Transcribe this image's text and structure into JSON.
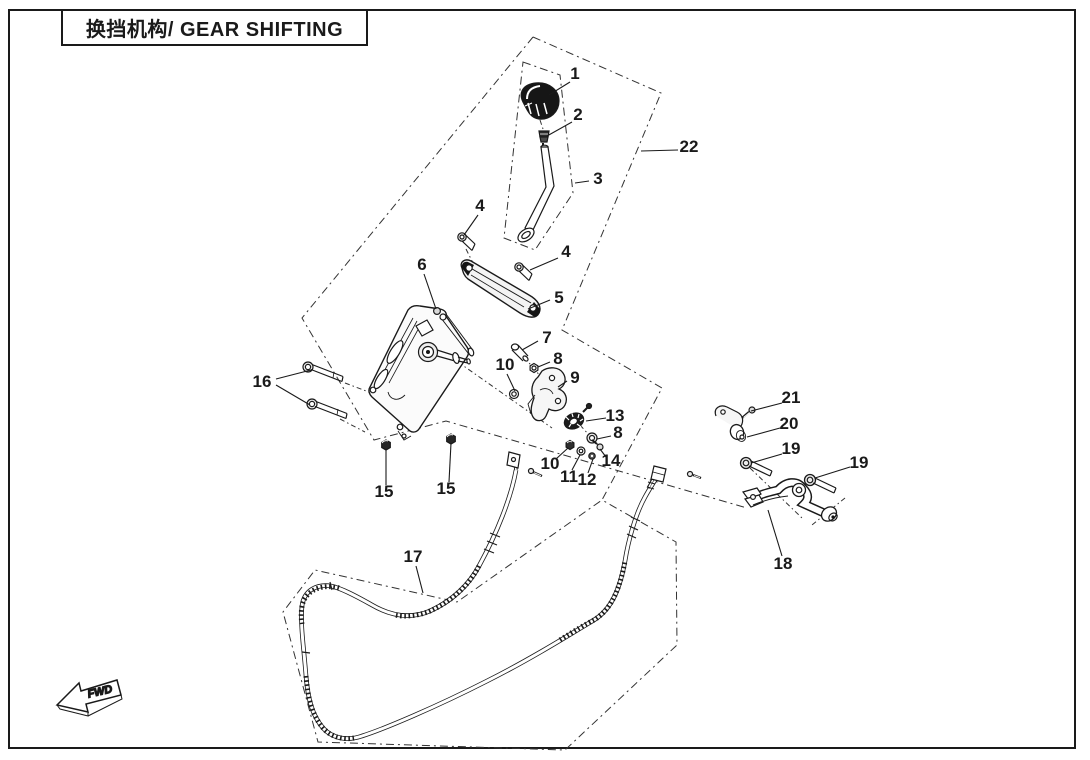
{
  "title": {
    "text": "换挡机构/ GEAR SHIFTING"
  },
  "direction_marker": {
    "label": "FWD"
  },
  "colors": {
    "ink": "#1a1a1a",
    "background": "#ffffff",
    "dash": "#333333"
  },
  "callouts": [
    {
      "num": "1",
      "x": 575,
      "y": 79,
      "leaders": [
        [
          570,
          82,
          549,
          95
        ]
      ]
    },
    {
      "num": "2",
      "x": 578,
      "y": 120,
      "leaders": [
        [
          572,
          122,
          547,
          136
        ]
      ]
    },
    {
      "num": "3",
      "x": 598,
      "y": 184,
      "leaders": [
        [
          589,
          181,
          575,
          183
        ]
      ]
    },
    {
      "num": "4",
      "x": 480,
      "y": 211,
      "leaders": [
        [
          478,
          215,
          464,
          235
        ]
      ]
    },
    {
      "num": "4",
      "x": 566,
      "y": 257,
      "leaders": [
        [
          558,
          258,
          530,
          270
        ]
      ]
    },
    {
      "num": "5",
      "x": 559,
      "y": 303,
      "leaders": [
        [
          550,
          300,
          528,
          309
        ]
      ]
    },
    {
      "num": "6",
      "x": 422,
      "y": 270,
      "leaders": [
        [
          424,
          274,
          436,
          309
        ]
      ]
    },
    {
      "num": "7",
      "x": 547,
      "y": 343,
      "leaders": [
        [
          538,
          341,
          522,
          350
        ]
      ]
    },
    {
      "num": "8",
      "x": 558,
      "y": 364,
      "leaders": [
        [
          550,
          362,
          538,
          367
        ]
      ]
    },
    {
      "num": "9",
      "x": 575,
      "y": 383,
      "leaders": [
        [
          567,
          381,
          558,
          387
        ]
      ]
    },
    {
      "num": "10",
      "x": 505,
      "y": 370,
      "leaders": [
        [
          507,
          374,
          515,
          391
        ]
      ]
    },
    {
      "num": "13",
      "x": 615,
      "y": 421,
      "leaders": [
        [
          606,
          418,
          586,
          421
        ]
      ]
    },
    {
      "num": "8",
      "x": 618,
      "y": 438,
      "leaders": [
        [
          611,
          436,
          597,
          439
        ]
      ]
    },
    {
      "num": "14",
      "x": 611,
      "y": 466,
      "leaders": [
        [
          606,
          457,
          600,
          449
        ]
      ]
    },
    {
      "num": "10",
      "x": 550,
      "y": 469,
      "leaders": [
        [
          556,
          459,
          568,
          448
        ]
      ]
    },
    {
      "num": "11",
      "x": 569,
      "y": 482,
      "leaders": [
        [
          572,
          470,
          580,
          455
        ]
      ]
    },
    {
      "num": "12",
      "x": 587,
      "y": 485,
      "leaders": [
        [
          588,
          473,
          593,
          459
        ]
      ]
    },
    {
      "num": "15",
      "x": 384,
      "y": 497,
      "leaders": [
        [
          386,
          485,
          386,
          450
        ]
      ]
    },
    {
      "num": "15",
      "x": 446,
      "y": 494,
      "leaders": [
        [
          449,
          482,
          451,
          443
        ]
      ]
    },
    {
      "num": "16",
      "x": 262,
      "y": 387,
      "leaders": [
        [
          276,
          379,
          311,
          370
        ],
        [
          276,
          385,
          310,
          405
        ]
      ]
    },
    {
      "num": "17",
      "x": 413,
      "y": 562,
      "leaders": [
        [
          416,
          566,
          423,
          593
        ]
      ]
    },
    {
      "num": "18",
      "x": 783,
      "y": 569,
      "leaders": [
        [
          782,
          556,
          768,
          510
        ]
      ]
    },
    {
      "num": "19",
      "x": 791,
      "y": 454,
      "leaders": [
        [
          782,
          454,
          751,
          463
        ]
      ]
    },
    {
      "num": "19",
      "x": 859,
      "y": 468,
      "leaders": [
        [
          850,
          467,
          815,
          478
        ]
      ]
    },
    {
      "num": "20",
      "x": 789,
      "y": 429,
      "leaders": [
        [
          780,
          428,
          747,
          437
        ]
      ]
    },
    {
      "num": "21",
      "x": 791,
      "y": 403,
      "leaders": [
        [
          782,
          403,
          751,
          411
        ]
      ]
    },
    {
      "num": "22",
      "x": 689,
      "y": 152,
      "leaders": [
        [
          678,
          150,
          641,
          151
        ]
      ]
    }
  ]
}
